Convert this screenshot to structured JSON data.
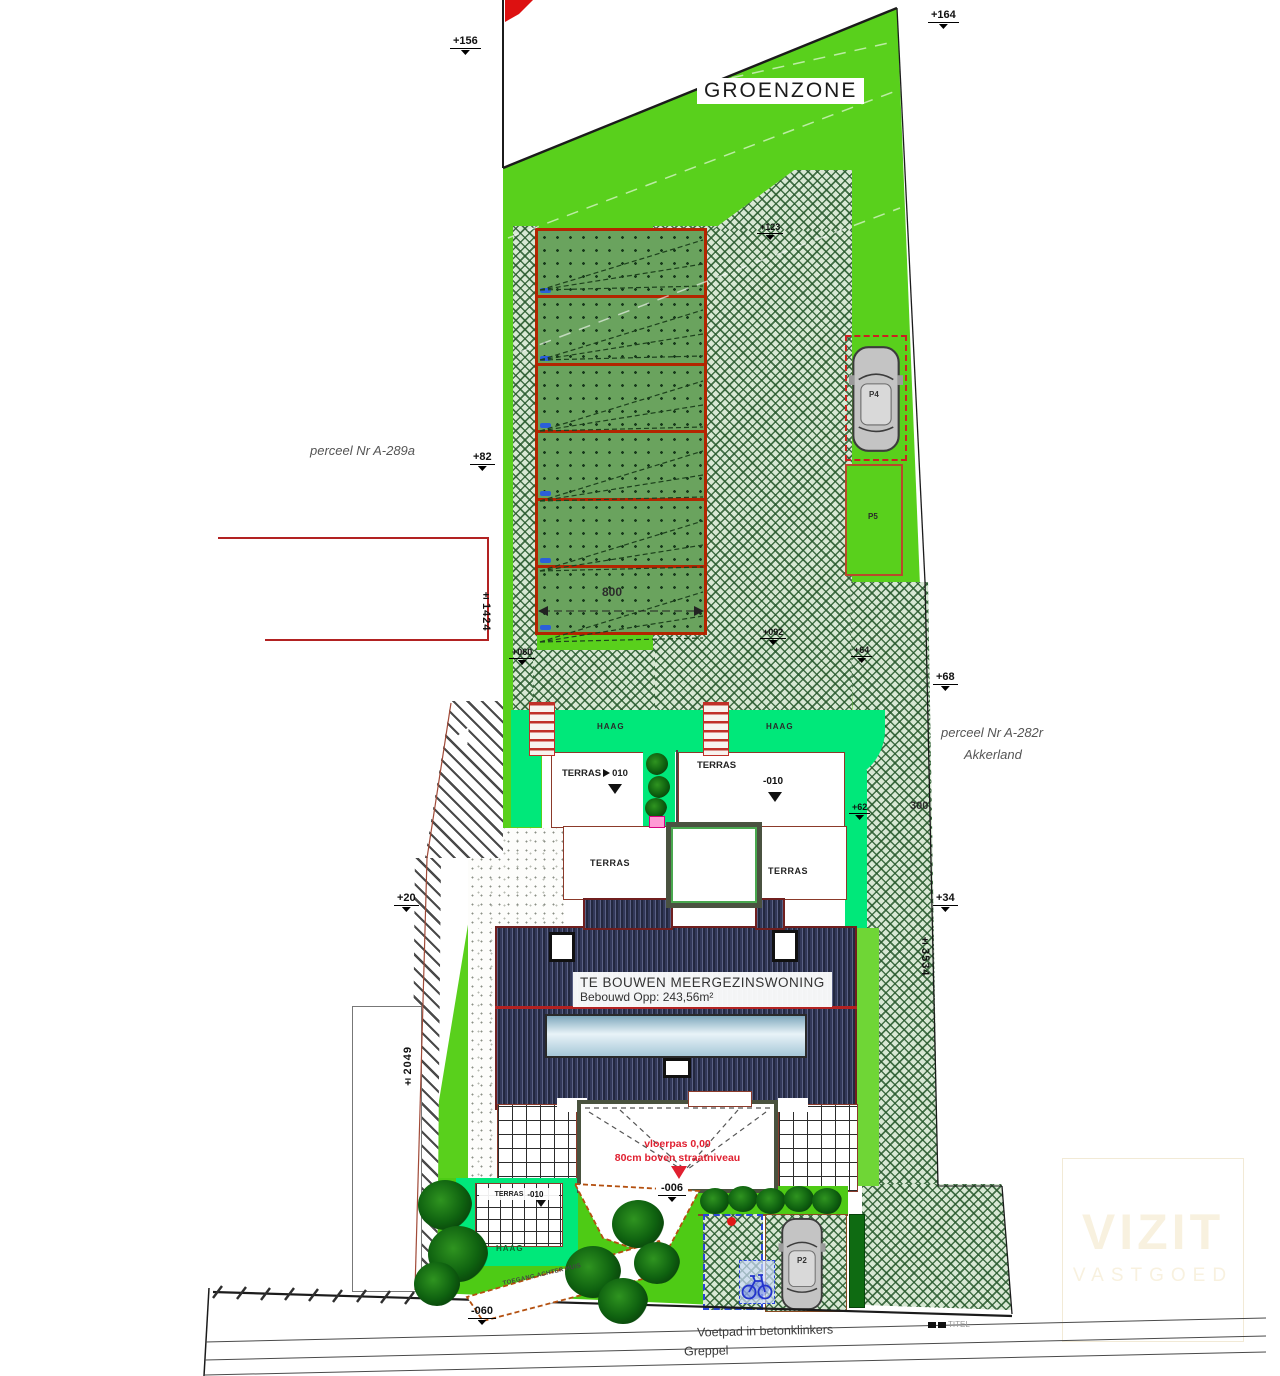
{
  "labels": {
    "groenzone": "GROENZONE",
    "parcel_left": "perceel Nr A-289a",
    "parcel_right1": "perceel Nr A-282r",
    "parcel_right2": "Akkerland",
    "building1": "TE BOUWEN MEERGEZINSWONING",
    "building2": "Bebouwd Opp: 243,56m²",
    "floor1": "vloerpas 0,00",
    "floor2": "80cm boven straatniveau",
    "haag_left": "HAAG",
    "haag_right": "HAAG",
    "haag_garden": "HAAG",
    "terras_tl": "TERRAS",
    "terras_tl_lvl": "010",
    "terras_tr": "TERRAS",
    "terras_tr_lvl": "-010",
    "terras_bl": "TERRAS",
    "terras_br": "TERRAS",
    "terras_g": "TERRAS",
    "terras_g_lvl": "-010",
    "p4": "P4",
    "p5": "P5",
    "p2": "P2",
    "path": "TOEGANG ACHTER HUIS",
    "sidewalk": "Voetpad in betonklinkers",
    "ditch": "Greppel",
    "titel": "TITEL"
  },
  "markers": {
    "m156": "+156",
    "m164": "+164",
    "m82": "+82",
    "m123": "+123",
    "m060": "+060",
    "m092": "+092",
    "m64": "+64",
    "m62": "+62",
    "m68": "+68",
    "m34": "+34",
    "m20": "+20",
    "m006": "-006",
    "m060b": "-060"
  },
  "dims": {
    "d800": "800",
    "d300": "300",
    "d1424": "±1424",
    "d3534": "±3534",
    "d2049": "±2049"
  },
  "watermark": {
    "l1": "VIZIT",
    "l2": "VASTGOED"
  },
  "colors": {
    "zone_green": "#59d01c",
    "haag_green": "#00e87a",
    "plot_green": "#6aa35e",
    "hatch_bg": "#d8e8d4",
    "building_navy": "#2c3150",
    "accent_red": "#c22a1e",
    "skylight_blue": "#bcd9e6"
  }
}
